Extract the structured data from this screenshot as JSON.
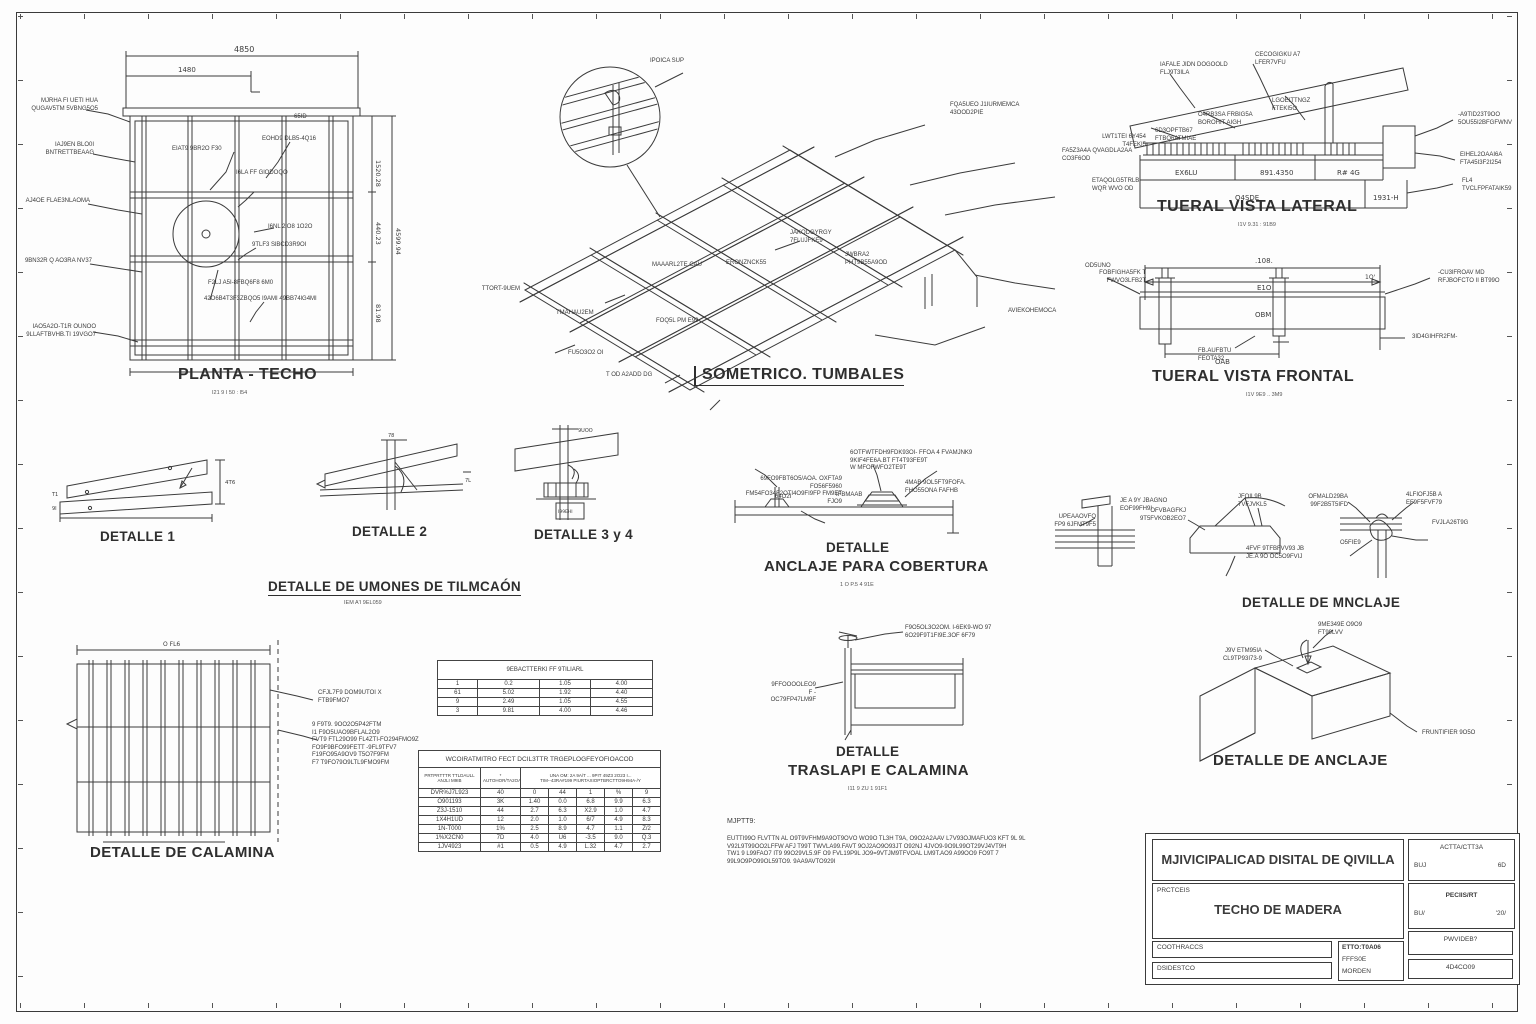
{
  "planta": {
    "title": "PLANTA - TECHO",
    "subtitle": "I21 9 I 50 : I54",
    "dims": {
      "top": "4850",
      "top2": "1480",
      "right1": "1520.28",
      "right2": "440.23",
      "right3": "81.98",
      "right_total": "4599.94",
      "corner": "65ID"
    },
    "left_labels": [
      "MJRHA FI UETI HUA\nQUGAV5TM 5VBNG5O5",
      "IAJ9EN BLO0I\nBNTRETTBEAAG",
      "AJ4OE FLAE3NLAOMA",
      "9BN32R Q AO3RA NV37",
      "IAO5A2O-T1R OUNOO\n9LLAFTBVHB.TI 19VGO7"
    ],
    "inner_labels": [
      "EIAT9 9BR2O F30",
      "EOHD9 DLB5-4Q16",
      "I6LA FF GlODOQO",
      "I6NL 2lO8 1O2O",
      "9TLF3 SlBCD3R9OI",
      "F2LJ A5I-8FBQ6F8 6M0",
      "42O6B4T3F3ZBQO5",
      "I9AMI 49BB74lG4MI"
    ]
  },
  "isometrico": {
    "title": "SOMETRICO. TUMBALES",
    "labels": {
      "circle": "IPOICA  SUP",
      "l1": "FQA5UEO J1IURMEMCA\n43OOD2PIE",
      "l2": "FA5Z3A4A QVAGDLA2AA\nCO3F6OD",
      "l3": "ETAQOLG5TRLB\nWQR WVO OD",
      "l4": "OD5UNO",
      "l5": "JAKODGYRGY\n7FI UJFKE9",
      "l6": "JWBRA2\nPHT9B55A9OD",
      "l7": "ERONZNCK55",
      "l8": "MAAARL2TE CAU",
      "l9": "TTORT-9UEM",
      "l10": "TMAHAU2EM",
      "l11": "FOQ5L PM E99",
      "l12": "AVIEKOHEMOCA",
      "l13": "FU5O3O2 OI",
      "l14": "T OD A2ADD DG"
    }
  },
  "lateral": {
    "title": "TUERAL VISTA LATERAL",
    "subtitle": "I1V  9.31 :  91B9",
    "cells": [
      "EX6LU",
      "891.4350",
      "R# 4G"
    ],
    "cells2": [
      "O4SDE",
      "1931-H"
    ],
    "labels": {
      "l1": "IAFALE JIDN DOGOOLD\nFLJ9T3ILA",
      "l2": "CECOGIGKU A7\nLFER7VFU",
      "l3": "LGOEITTNGZ\nFTEKI5O",
      "l4": "O4RB3SA FRBIG5A\nBOROHIT AIGH",
      "l5": "6D3OPFTB67\nFTBQ6ATMIAE",
      "l6": "LWT1TEI 6Y454\nT4FEKI5",
      "l7": "-A9TID23T9OO\n5OU55I2BFGFWNV",
      "l8": "EIHEL2OAAI6A\nFTA45I3F2I254",
      "l9": "FL4\nTVCLFPFATAIK59"
    }
  },
  "frontal": {
    "title": "TUERAL VISTA FRONTAL",
    "subtitle": "I1V 9E9 .. 3M9",
    "dims": {
      "top": ".108.",
      "mid": "E1O",
      "right": "1O'",
      "band": "OBM",
      "bottom": "OAB"
    },
    "labels": {
      "l1": "FOBFIGHA5FK T\nFWVO3LFB2T",
      "l2": "-CU3lFROAV MD\nRFJBOFCTO II BT99O",
      "l3": "FB.AUFBTU\nFEOTA32",
      "l4": "3ID4GIHFR2FM-"
    }
  },
  "detalle1": {
    "title": "DETALLE 1",
    "dim_r": "4T6",
    "dim_l1": "T1",
    "dim_l2": "9I"
  },
  "detalle2": {
    "title": "DETALLE 2",
    "dim_t": "78",
    "dim_r": "7L"
  },
  "detalle34": {
    "title": "DETALLE 3 y 4",
    "dim_t": "9UOO",
    "dim_b": "I99EHI"
  },
  "uniones": {
    "title": "DETALLE DE UMONES DE TILMCAÓN",
    "subtitle": "IEM A'I  9EL059"
  },
  "anclaje_cobertura": {
    "title1": "DETALLE",
    "title2": "ANCLAJE PARA COBERTURA",
    "subtitle": "1 O  P.5 4 91E",
    "labels": {
      "top": "6OTFWTFDH9FDK93OI- FFOA 4 FVAMJNK9\n9KIF4FE6A.BT FT4T93FE9T\nW MFOFWFO2TE9T",
      "left": "69FO9FBT6O5/AOA. OXFTA9 FO56F5960\nFM54FO34F2OTI4O9FI9FP FM9ET FJO9",
      "right": "4MAB 9OL5FT9FOFA.\nFHO55ONA FAFHB",
      "s1": "64O2I",
      "s2": "IFBMAAB"
    }
  },
  "mnclaje": {
    "title": "DETALLE DE MNCLAJE",
    "labels": {
      "s1a": "UPEAAOVFO\nFP9 6JFMT9F5",
      "s1b": "JE A 9Y JBAGNO\nEOF99FH9I",
      "s2a": "OFVBAGFKJ\n9T5FVKOB2EO7",
      "s2b": "JFOIL9B\n7VFJVKL5",
      "s2c": "4FVF 9TFBFVV93 JB\nJE.A 9O OC5O9FVIJ",
      "s3a": "OFMALD29BA\n99F2B5T5IFD",
      "s3b": "4LFIOFJ5B A\nEF9F5FVF79",
      "s3c": "FVJLA26T9G",
      "s3d": "O5FIE9"
    }
  },
  "calamina": {
    "title": "DETALLE DE CALAMINA",
    "dim": "O FL6",
    "label1": "CFJL7F9 DOM9UTOI X\nFTB9FMO7",
    "label2": "9 F9T9. 9OO2O5P42FTM\nI1 F9O5UAO9BFLAL2O9\nFVT9 FTL29O99 FL4ZTI-FO294FMO9Z\nFO9F9BFO99FETT -9FL9TFV7\nF19FO95A9OV9 T5O7F9FM\nF7 T9FO79O9LTL9FMO9FM"
  },
  "tables": {
    "t1": {
      "title": "9EBACTTERKI  FF  9TILIARL",
      "rows": [
        [
          "1",
          "0.2",
          "1.05",
          "4.00"
        ],
        [
          "61",
          "5.02",
          "1.92",
          "4.40"
        ],
        [
          "9",
          "2.49",
          "1.05",
          "4.55"
        ],
        [
          "3",
          "9.81",
          "4.00",
          "4.46"
        ]
      ]
    },
    "t2": {
      "title": "WCOIRATMITRO FECT DCIL3TTR TRGEPLOGFEYOFIOACOD",
      "h1": "PRTPRTTTR TTLDAULL\nANJLI M9IB",
      "h2": "*\nAUTOHOR/TA2OAB",
      "h3": "UNA OM: 2A 9A/T ...   9PIT    49Z3 2O23 I...\nTIM--43RA#199 PIURTAXIOPTBRCTTO9H94A-/Y",
      "rows": [
        [
          "DVR%J7L923",
          "40",
          "0",
          "44",
          "1",
          "%",
          "9"
        ],
        [
          "O901193",
          "3K",
          "1.40",
          "0.0",
          "6.8",
          "9.9",
          "6.3"
        ],
        [
          "Z3J-1510",
          "44",
          "2.7",
          "6.3",
          "X2.9",
          "1.0",
          "4.7"
        ],
        [
          "1X4H1UD",
          "12",
          "2.0",
          "1.0",
          "6/7",
          "4.9",
          "8.3"
        ],
        [
          "1N-T000",
          "1%",
          "2.5",
          "8.9",
          "4.7",
          "1.1",
          "Z/2"
        ],
        [
          "1%X2CN0",
          "7D",
          "4.0",
          "U6",
          "-3.5",
          "9.0",
          "Q.3"
        ],
        [
          "1JV4923",
          "#1",
          "0.5",
          "4.9",
          "L.32",
          "4.7",
          "2.7"
        ]
      ]
    }
  },
  "traslape": {
    "title1": "DETALLE",
    "title2": "TRASLAPI E CALAMINA",
    "subtitle": "I11 9 ZU  1 91F1",
    "labels": {
      "right": "F9O5OL3O2OM. I-6EK9-WO 97\n6O29F9T1FI9E.3OF 6F79",
      "left": "9FFOOOOLEO9 F -\nOC79FP47LM9F"
    }
  },
  "anclaje3d": {
    "title": "DETALLE DE ANCLAJE",
    "labels": {
      "top": "9ME349E O9O9\nFT99LVV",
      "left": "J9V ETM95IA\nCL9TP93I73-9",
      "bottom": "FRUNTIFIER 9O5O"
    }
  },
  "notes": {
    "header": "MJPTT9:",
    "body": "EUTTI99O FLVTTN AL O9T9VFHM9A9OT9OVO WO9O TL3H T9A, O9O2A2AAV L7V93OJMAFUO3 KFT 9L 9L\nV92L9T99OO2LFFW AFJ T99T  TWVLA99.FAVT 9OJ2AO9O93JT O92NJ 4JVO9-9O9L99OT29VJ4VT9H\nTW1 9  L99FAO7 IT9 99O29VL5.9F O9 FVL19P9L JO9=9VTJM9TFVOAL LM9T.AO9 A99OO9 FO9T 7\n99L9O9PO99OL59TO9. 9AA9AVTO929I"
  },
  "titleblock": {
    "org": "MJIVICIPALICAD DISITAL DE QIVILLA",
    "project_label": "PRCTCEIS",
    "project": "TECHO DE MADERA",
    "row1": "COOTHRACCS",
    "row2": "DSIDESTCO",
    "mid1": "ETTO:T0A06",
    "mid2": "FFFS0E",
    "mid3": "MORDEN",
    "r1a": "ACTTA/CTT3A",
    "r1b": "BUJ",
    "r1c": "6D",
    "r2a": "PECIIS/RT",
    "r2b": "BU/",
    "r2c": "'20/",
    "r3": "PWVIDEB?",
    "r4": "4D4CO09"
  }
}
